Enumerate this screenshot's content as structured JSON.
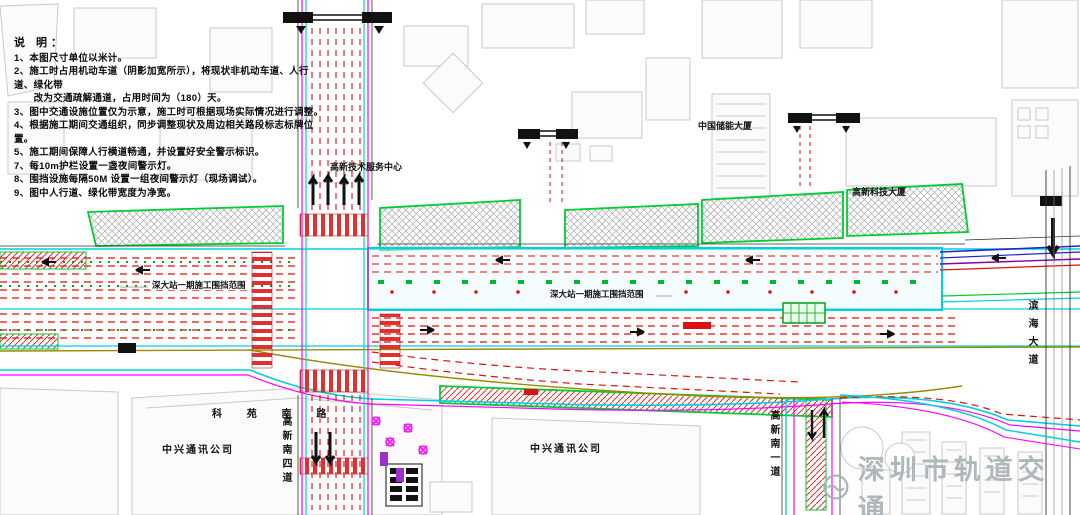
{
  "drawing": {
    "type": "construction-traffic-diversion-plan",
    "station": "深大站"
  },
  "notes": {
    "title": "说 明：",
    "items": [
      "1、本图尺寸单位以米计。",
      "2、施工时占用机动车道（阴影加宽所示），将现状非机动车道、人行道、绿化带",
      "　　改为交通疏解通道，占用时间为（180）天。",
      "3、图中交通设施位置仅为示意，施工时可根据现场实际情况进行调整。",
      "4、根据施工期间交通组织，同步调整现状及周边相关路段标志标牌位置。",
      "5、施工期间保障人行横道畅通，并设置好安全警示标识。",
      "7、每10m护栏设置一盏夜间警示灯。",
      "8、围挡设施每隔50M 设置一组夜间警示灯（现场调试）。",
      "9、图中人行道、绿化带宽度为净宽。"
    ]
  },
  "labels": {
    "building_service_center": "高新技术服务中心",
    "building_chuneng": "中国储能大厦",
    "building_keji": "高新科技大厦",
    "enclosure_left": "深大站一期施工围挡范围",
    "enclosure_center": "深大站一期施工围挡范围",
    "road_keyuan": "科 苑 南 路",
    "company_left": "中兴通讯公司",
    "company_center": "中兴通讯公司",
    "road_gaoxin4": "高新南四道",
    "road_gaoxin1": "高新南一道",
    "road_binhai": "滨海大道",
    "watermark": "深圳市轨道交通"
  },
  "colors": {
    "lane_red": "#dd1111",
    "edge_cyan": "#00cfe0",
    "edge_magenta": "#ff00ff",
    "zone_green": "#00cc33",
    "curb_olive": "#9a8a00",
    "trunk_blue": "#2222cc",
    "trunk_purple": "#8800aa",
    "building_gray": "#c9c9c9",
    "watermark_gray": "#a9b2b6"
  }
}
